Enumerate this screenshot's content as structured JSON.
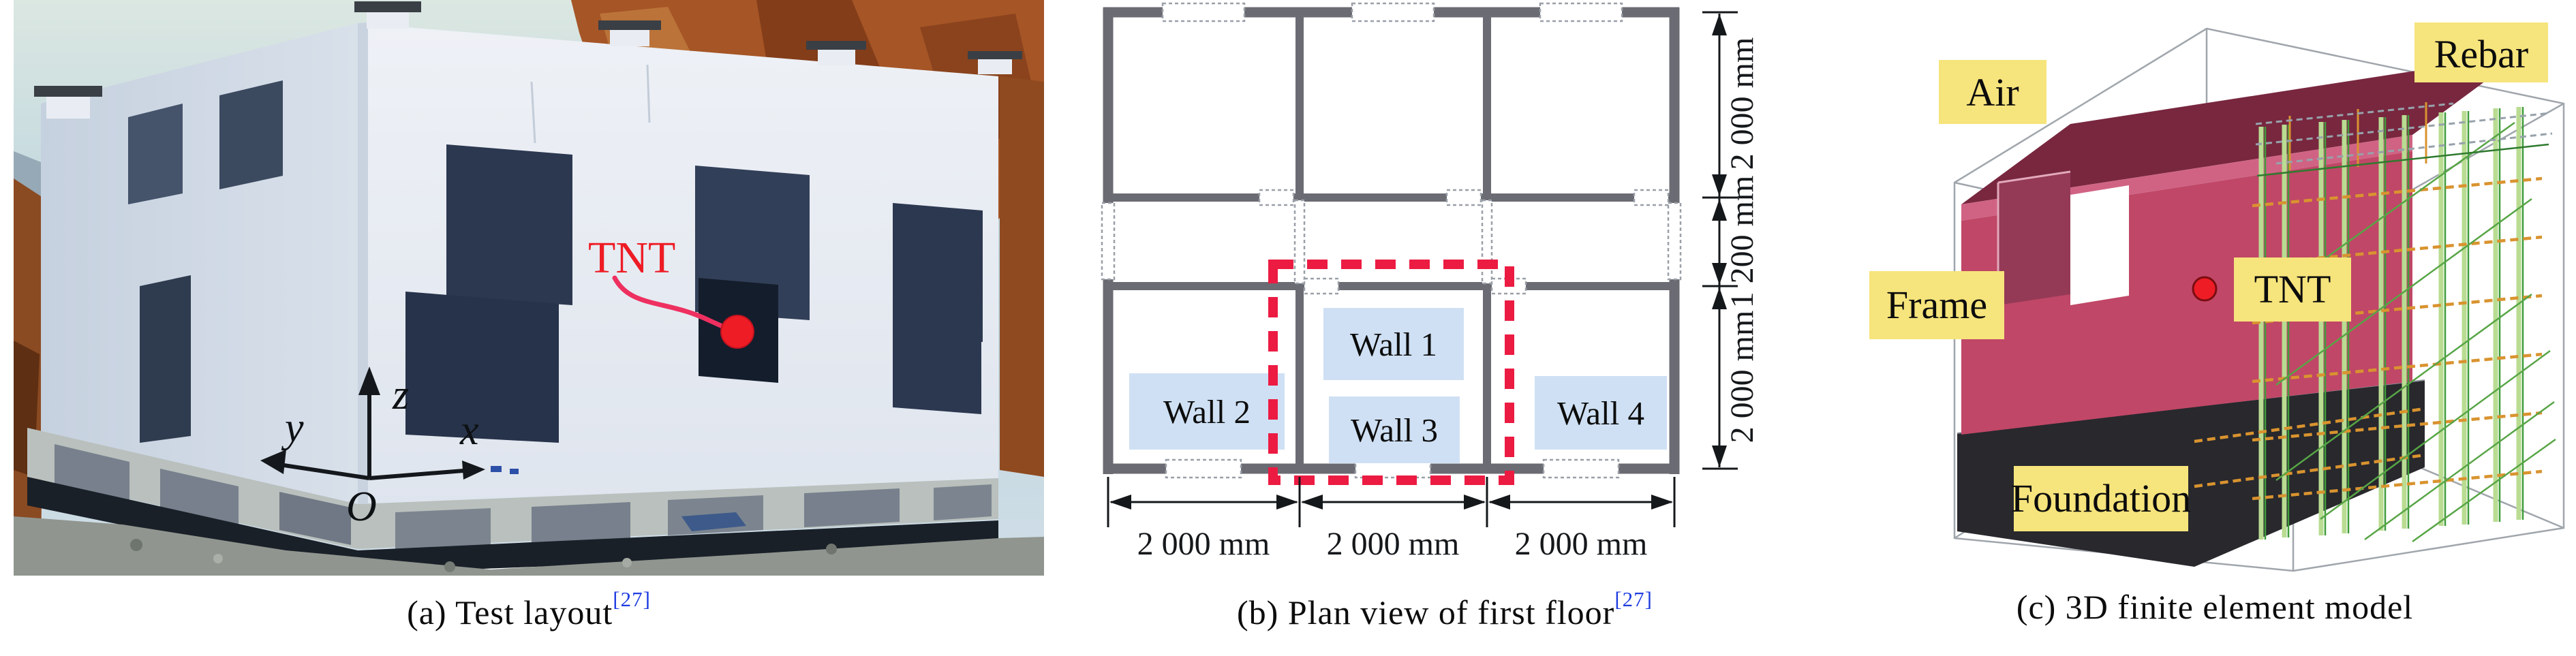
{
  "figure": {
    "panel_a": {
      "caption": "(a) Test layout",
      "ref": "[27]",
      "tnt_label": "TNT",
      "axis_x": "x",
      "axis_y": "y",
      "axis_z": "z",
      "origin": "O"
    },
    "panel_b": {
      "caption": "(b) Plan view of first floor",
      "ref": "[27]",
      "walls": [
        "Wall 1",
        "Wall 2",
        "Wall 3",
        "Wall 4"
      ],
      "dims_bottom": [
        "2 000 mm",
        "2 000 mm",
        "2 000 mm"
      ],
      "dims_right": [
        "2 000 mm",
        "1 200 mm",
        "2 000 mm"
      ]
    },
    "panel_c": {
      "caption": "(c) 3D finite element model",
      "labels": {
        "air": "Air",
        "rebar": "Rebar",
        "frame": "Frame",
        "tnt": "TNT",
        "foundation": "Foundation"
      }
    },
    "colors": {
      "tnt_red": "#ee1c25",
      "arrow_pink": "#ee3060",
      "dashed_red": "#ec1b42",
      "label_yellow": "#f6e47c",
      "frame_crimson": "#c04767",
      "roof_maroon": "#78273f",
      "slab_band": "#d06384",
      "window_recess": "#943a56",
      "foundation_dark": "#28282d",
      "rebar_green": "#3f9d3b",
      "rebar_light_green": "#b9dc92",
      "rebar_orange": "#d9932f",
      "wall_gray": "#6b6b73",
      "room_highlight": "#cfe0f4",
      "ref_blue": "#1e3ce0"
    }
  }
}
